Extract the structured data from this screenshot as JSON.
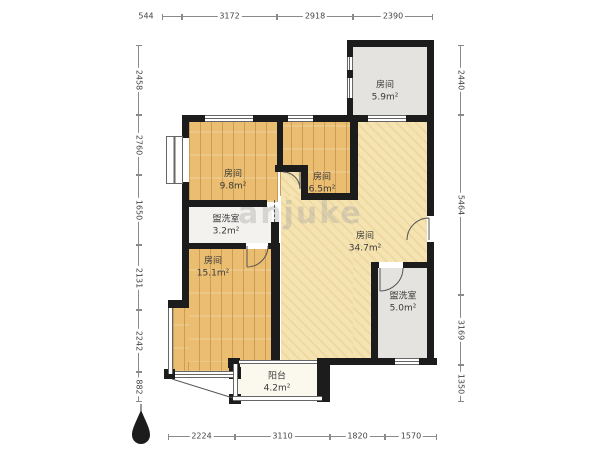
{
  "watermark": "anjuke",
  "rooms": [
    {
      "id": "bedroom-a",
      "name": "房间",
      "area": "9.8m²"
    },
    {
      "id": "bedroom-b",
      "name": "房间",
      "area": "6.5m²"
    },
    {
      "id": "room-c",
      "name": "房间",
      "area": "5.9m²"
    },
    {
      "id": "washroom-a",
      "name": "盥洗室",
      "area": "3.2m²"
    },
    {
      "id": "living-room",
      "name": "房间",
      "area": "34.7m²"
    },
    {
      "id": "bedroom-d",
      "name": "房间",
      "area": "15.1m²"
    },
    {
      "id": "washroom-b",
      "name": "盥洗室",
      "area": "5.0m²"
    },
    {
      "id": "balcony",
      "name": "阳台",
      "area": "4.2m²"
    }
  ],
  "dimensions": {
    "top": [
      "544",
      "3172",
      "2918",
      "2390"
    ],
    "bottom": [
      "2224",
      "3110",
      "1820",
      "1570"
    ],
    "left": [
      "2458",
      "2760",
      "1650",
      "2131",
      "2242",
      "882"
    ],
    "right": [
      "2440",
      "5464",
      "3169",
      "1350"
    ]
  },
  "colors": {
    "wall": "#1c1c1c",
    "wood_floor": "#eabd70",
    "main_floor": "#f5e4b2",
    "gray_floor": "#e5e3df",
    "washroom_floor": "#f3f2ef",
    "balcony_floor": "#fbf8ee",
    "dimension_line": "#8a8a8a"
  }
}
